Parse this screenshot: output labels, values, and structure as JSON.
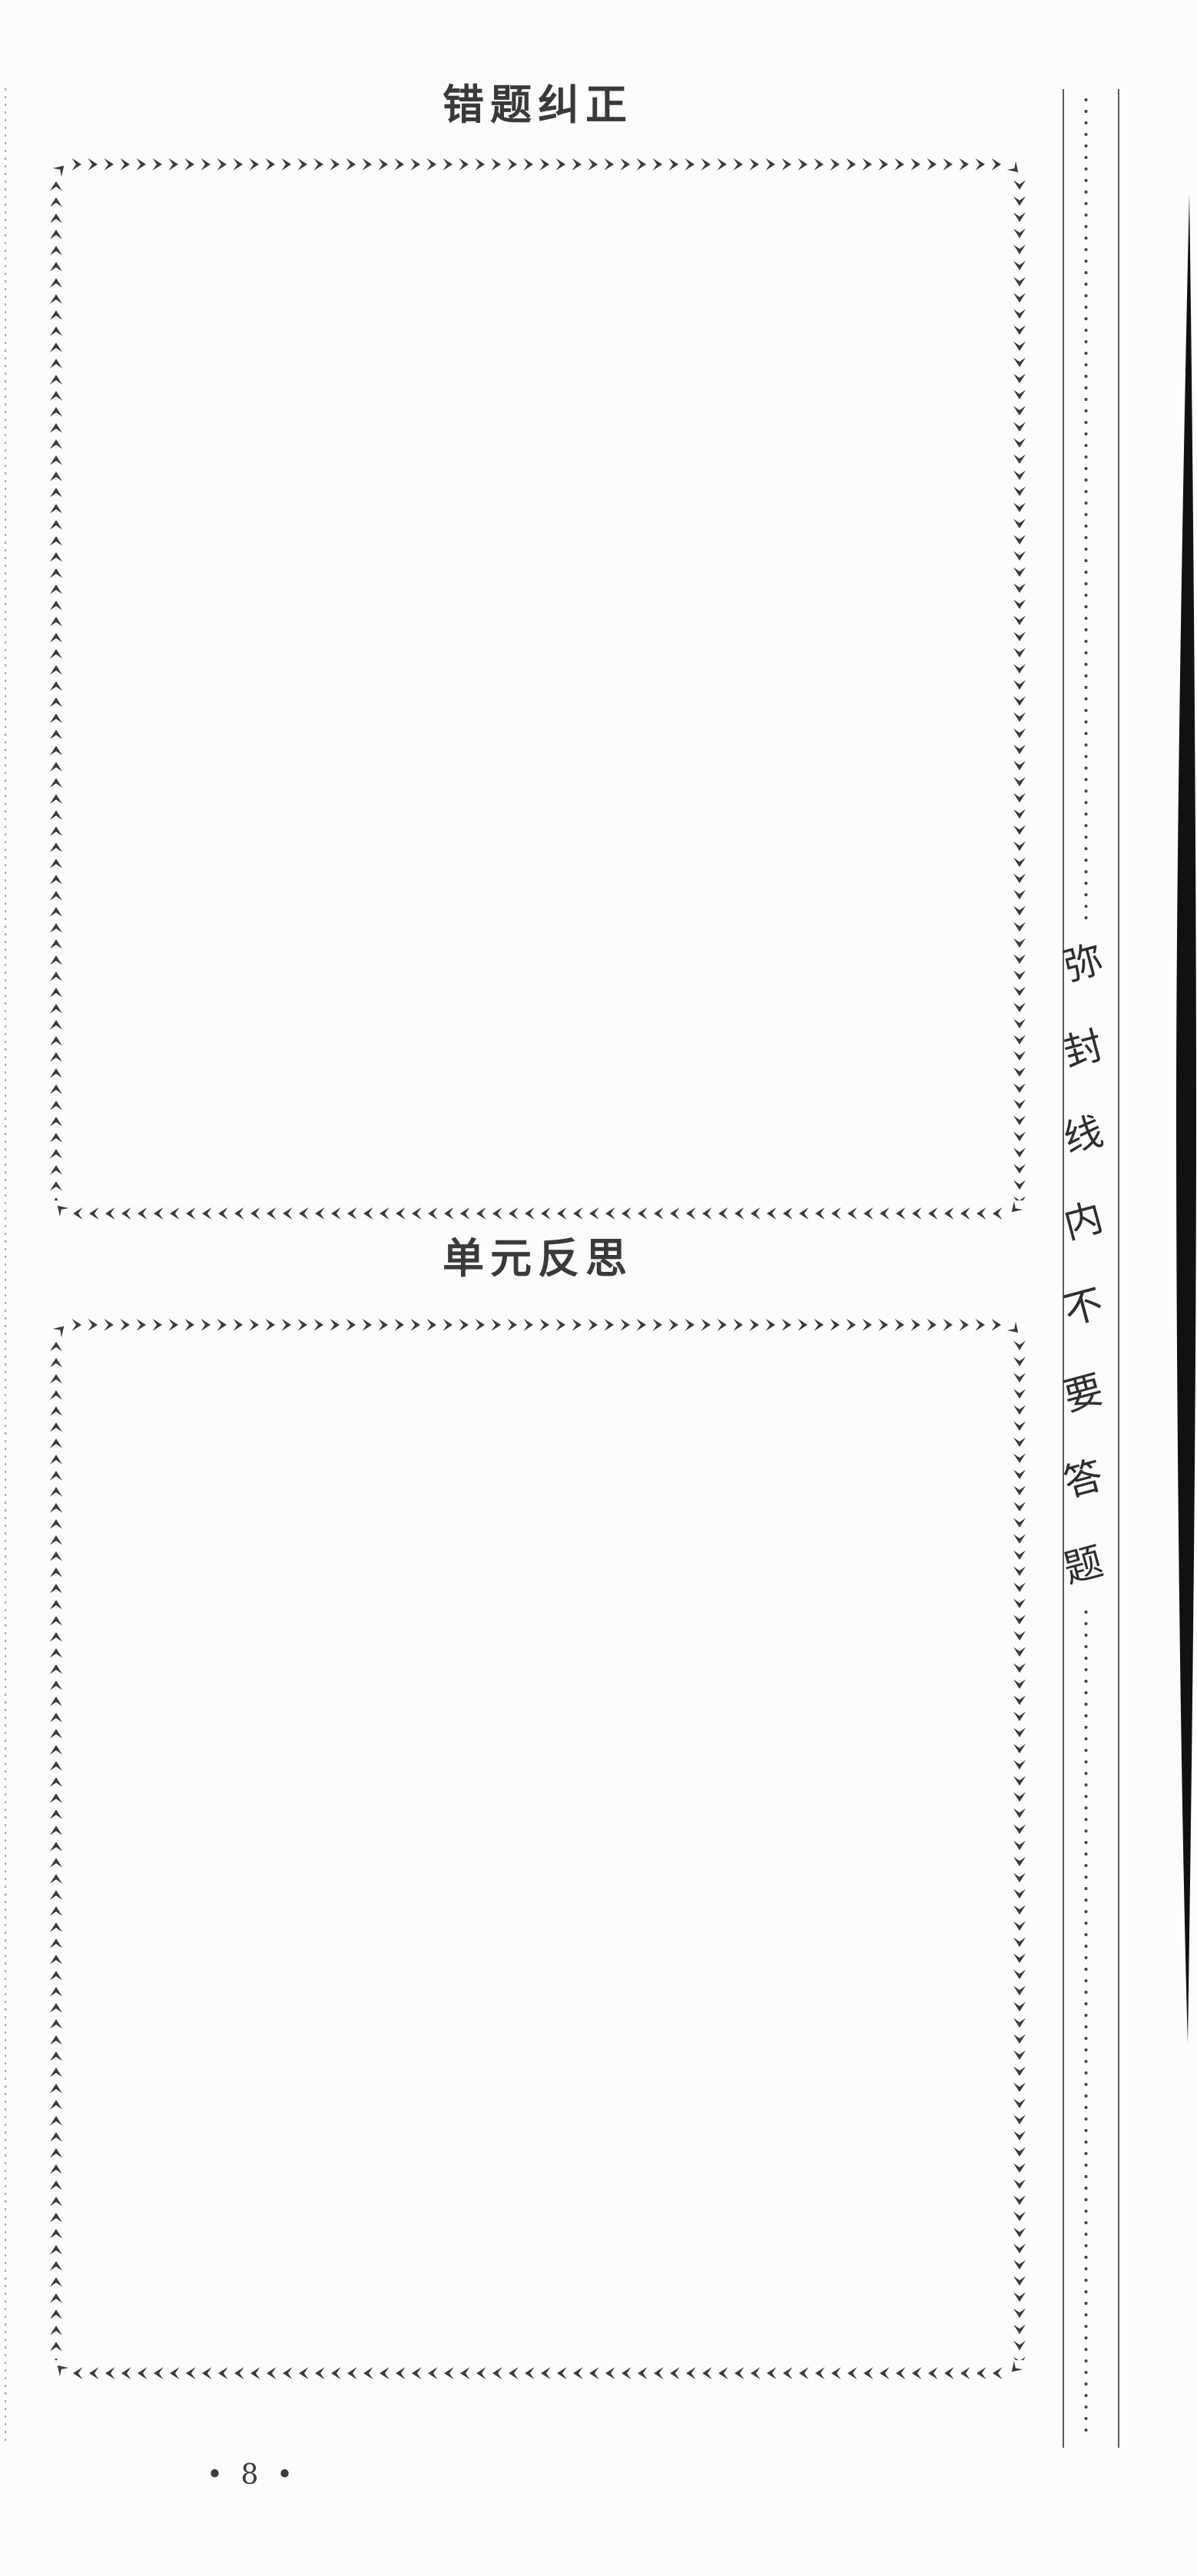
{
  "document": {
    "sections": [
      {
        "title": "错题纠正"
      },
      {
        "title": "单元反思"
      }
    ],
    "seal_line": {
      "full_text": "弥封线内不要答题",
      "chars": [
        "弥",
        "封",
        "线",
        "内",
        "不",
        "要",
        "答",
        "题"
      ]
    },
    "footer": {
      "page_number": "• 8 •"
    }
  },
  "colors": {
    "paper": "#fcfcfa",
    "ink": "#3a3a3a",
    "border_arrow": "#3b3b3b",
    "seal_rule": "#5c5c5c",
    "seal_dot": "#474747",
    "edge_dot": "#a9a9a6",
    "scan_shadow": "#111111"
  }
}
